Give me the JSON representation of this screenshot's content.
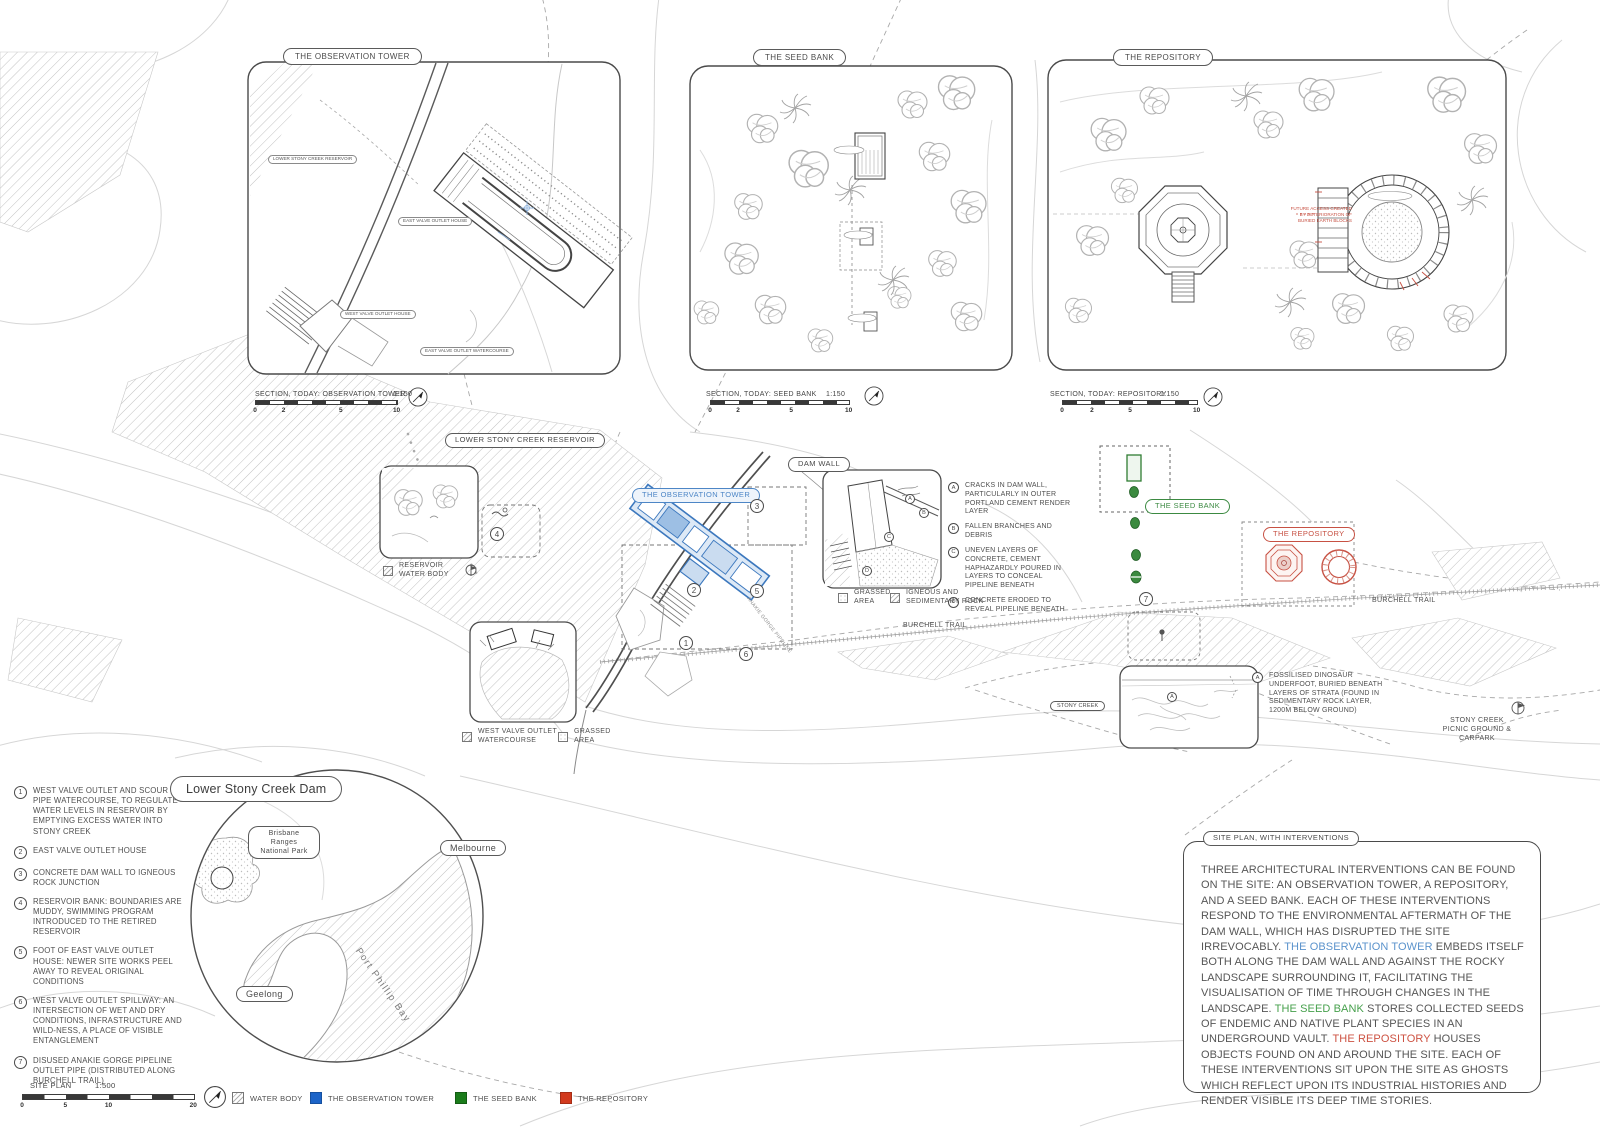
{
  "colors": {
    "tower_blue": "#3c78be",
    "seed_green": "#2f7d33",
    "repository_red": "#c75143",
    "legend_blue": "#1c64c8",
    "legend_green": "#1b7c1b",
    "legend_red": "#d23a1e",
    "linework": "#4a4a4a",
    "contour": "#d3d3d3"
  },
  "panels": {
    "observation_tower": {
      "title": "THE OBSERVATION TOWER",
      "section_label": "SECTION, TODAY: OBSERVATION TOWER",
      "scale": "1:150",
      "ticks": [
        "0",
        "2",
        "5",
        "10"
      ],
      "inner_labels": {
        "reservoir": "LOWER STONY CREEK RESERVOIR",
        "east_valve_house": "EAST VALVE OUTLET HOUSE",
        "west_valve_house": "WEST VALVE OUTLET HOUSE",
        "east_valve_watercourse": "EAST VALVE OUTLET WATERCOURSE"
      }
    },
    "seed_bank": {
      "title": "THE SEED BANK",
      "section_label": "SECTION, TODAY: SEED BANK",
      "scale": "1:150",
      "ticks": [
        "0",
        "2",
        "5",
        "10"
      ]
    },
    "repository": {
      "title": "THE REPOSITORY",
      "section_label": "SECTION, TODAY: REPOSITORY",
      "scale": "1:150",
      "ticks": [
        "0",
        "2",
        "5",
        "10"
      ],
      "red_note": "FUTURE ACCESS CREATED BY DETERIORATION OF BURIED EARTH BLOCKS"
    }
  },
  "site_plan": {
    "labels": {
      "reservoir": "LOWER STONY CREEK RESERVOIR",
      "dam_wall": "DAM WALL",
      "observation_tower": "THE OBSERVATION TOWER",
      "seed_bank": "THE SEED BANK",
      "repository": "THE REPOSITORY",
      "burchell_trail_mid": "BURCHELL TRAIL",
      "burchell_trail_right": "BURCHELL TRAIL",
      "stony_creek": "STONY CREEK",
      "picnic_ground": "STONY CREEK PICNIC GROUND & CARPARK",
      "anakie_pipeline": "ANAKIE GORGE PIPELINE"
    },
    "legends": {
      "reservoir_water_body": "RESERVOIR WATER BODY",
      "west_valve_watercourse": "WEST VALVE OUTLET WATERCOURSE",
      "grassed_area_west": "GRASSED AREA",
      "grassed_area_dam": "GRASSED AREA",
      "igneous": "IGNEOUS AND SEDIMENTARY ROCK"
    },
    "markers": [
      "1",
      "2",
      "3",
      "4",
      "5",
      "6",
      "7"
    ],
    "dam_notes": [
      {
        "key": "A",
        "text": "CRACKS IN DAM WALL, PARTICULARLY IN OUTER PORTLAND CEMENT RENDER LAYER"
      },
      {
        "key": "B",
        "text": "FALLEN BRANCHES AND DEBRIS"
      },
      {
        "key": "C",
        "text": "UNEVEN LAYERS OF CONCRETE, CEMENT HAPHAZARDLY POURED IN LAYERS TO CONCEAL PIPELINE BENEATH"
      },
      {
        "key": "D",
        "text": "CONCRETE ERODED TO REVEAL PIPELINE BENEATH"
      }
    ],
    "fossil_note": {
      "key": "A",
      "text": "FOSSILISED DINOSAUR UNDERFOOT, BURIED BENEATH LAYERS OF STRATA (FOUND IN SEDIMENTARY ROCK LAYER, 1200M BELOW GROUND)"
    }
  },
  "key_notes": [
    {
      "num": "1",
      "text": "WEST VALVE OUTLET AND SCOUR PIPE WATERCOURSE, TO REGULATE WATER LEVELS IN RESERVOIR BY EMPTYING EXCESS WATER INTO STONY CREEK"
    },
    {
      "num": "2",
      "text": "EAST VALVE OUTLET HOUSE"
    },
    {
      "num": "3",
      "text": "CONCRETE DAM WALL TO IGNEOUS ROCK JUNCTION"
    },
    {
      "num": "4",
      "text": "RESERVOIR BANK: BOUNDARIES ARE MUDDY, SWIMMING PROGRAM INTRODUCED TO THE RETIRED RESERVOIR"
    },
    {
      "num": "5",
      "text": "FOOT OF EAST VALVE OUTLET HOUSE: NEWER SITE WORKS PEEL AWAY TO REVEAL ORIGINAL CONDITIONS"
    },
    {
      "num": "6",
      "text": "WEST VALVE OUTLET SPILLWAY: AN INTERSECTION OF WET AND DRY CONDITIONS, INFRASTRUCTURE AND WILD-NESS, A PLACE OF VISIBLE ENTANGLEMENT"
    },
    {
      "num": "7",
      "text": "DISUSED ANAKIE GORGE PIPELINE OUTLET PIPE (DISTRIBUTED ALONG BURCHELL TRAIL)"
    }
  ],
  "locator_map": {
    "title": "Lower Stony Creek Dam",
    "park": "Brisbane Ranges National Park",
    "melbourne": "Melbourne",
    "geelong": "Geelong",
    "bay": "Port Phillip Bay"
  },
  "site_scale": {
    "label": "SITE PLAN",
    "scale": "1:500",
    "ticks": [
      "0",
      "5",
      "10",
      "20"
    ]
  },
  "site_legend": [
    {
      "label": "WATER BODY"
    },
    {
      "label": "THE OBSERVATION TOWER"
    },
    {
      "label": "THE SEED BANK"
    },
    {
      "label": "THE REPOSITORY"
    }
  ],
  "statement": {
    "title": "SITE PLAN, WITH INTERVENTIONS",
    "p1": "THREE ARCHITECTURAL INTERVENTIONS CAN BE FOUND ON THE SITE: AN OBSERVATION TOWER, A REPOSITORY, AND A SEED BANK. EACH OF THESE INTERVENTIONS RESPOND TO THE ENVIRONMENTAL AFTERMATH OF THE DAM WALL, WHICH HAS DISRUPTED THE SITE IRREVOCABLY. ",
    "tower": "THE OBSERVATION TOWER",
    "p2": " EMBEDS ITSELF BOTH ALONG THE DAM WALL AND AGAINST THE ROCKY LANDSCAPE SURROUNDING IT, FACILITATING THE VISUALISATION OF TIME THROUGH CHANGES IN THE LANDSCAPE. ",
    "seed": "THE SEED BANK",
    "p3": " STORES COLLECTED SEEDS OF ENDEMIC AND NATIVE PLANT SPECIES IN AN UNDERGROUND VAULT. ",
    "repository": "THE REPOSITORY",
    "p4": " HOUSES OBJECTS FOUND ON AND AROUND THE SITE. EACH OF THESE INTERVENTIONS SIT UPON THE SITE AS GHOSTS WHICH REFLECT UPON ITS INDUSTRIAL HISTORIES AND RENDER VISIBLE ITS DEEP TIME STORIES."
  }
}
